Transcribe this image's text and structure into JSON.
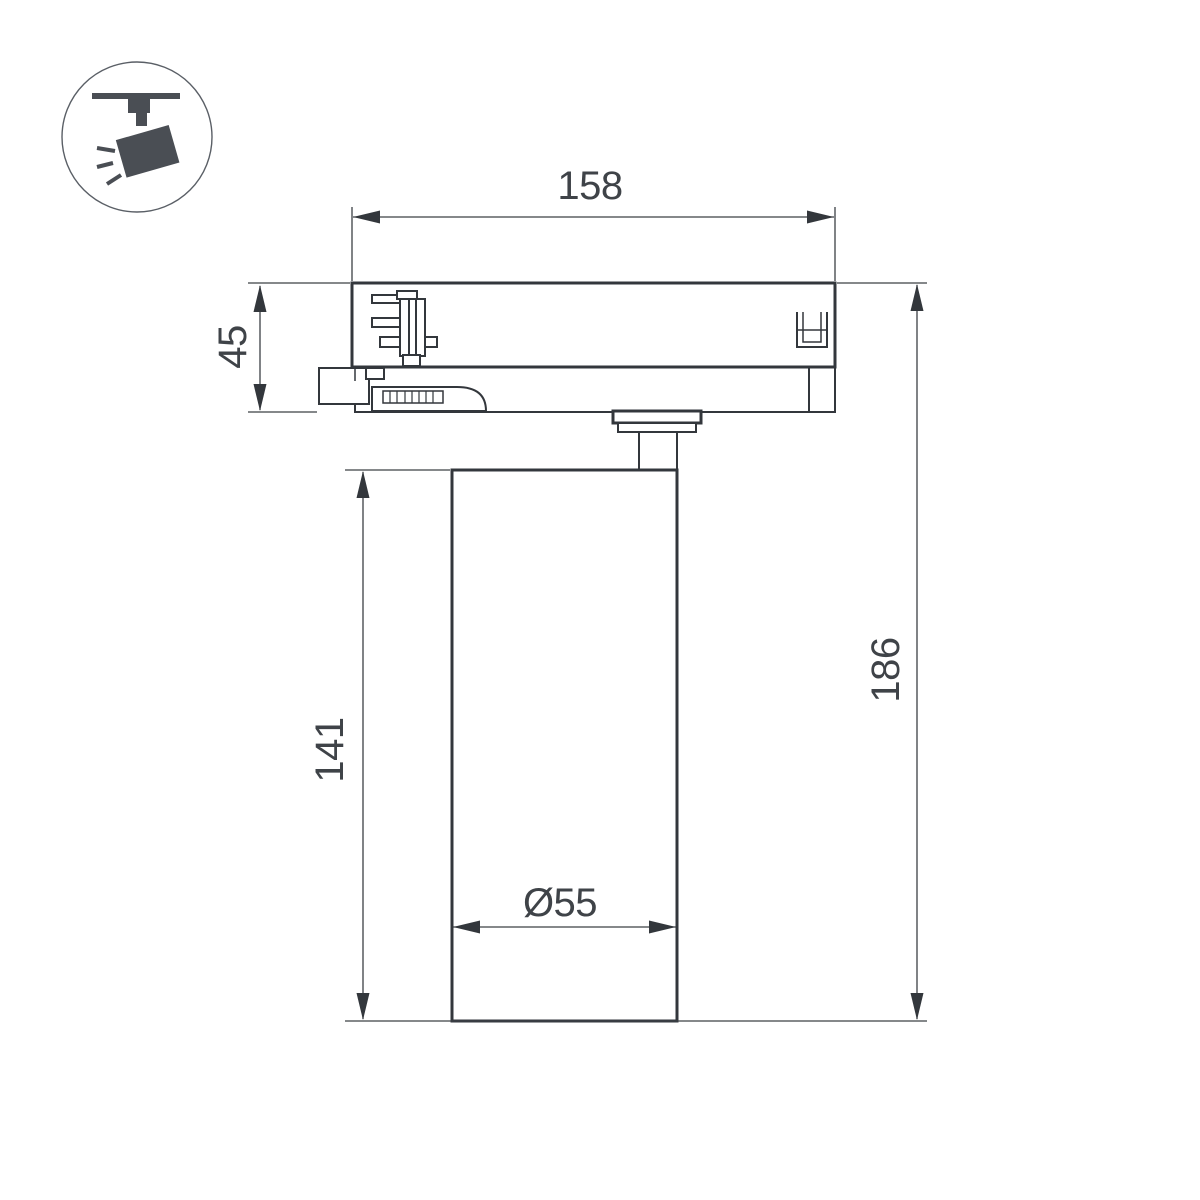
{
  "icon": {
    "name": "track-spotlight-pictogram"
  },
  "drawing": {
    "title": "track spotlight dimension drawing",
    "dimensions": {
      "adapter_width": "158",
      "adapter_height": "45",
      "body_height": "141",
      "total_height": "186",
      "body_diameter": "Ø55"
    },
    "colors": {
      "line": "#33373c",
      "dim_text": "#3f4348",
      "icon": "#4a4e54"
    }
  }
}
